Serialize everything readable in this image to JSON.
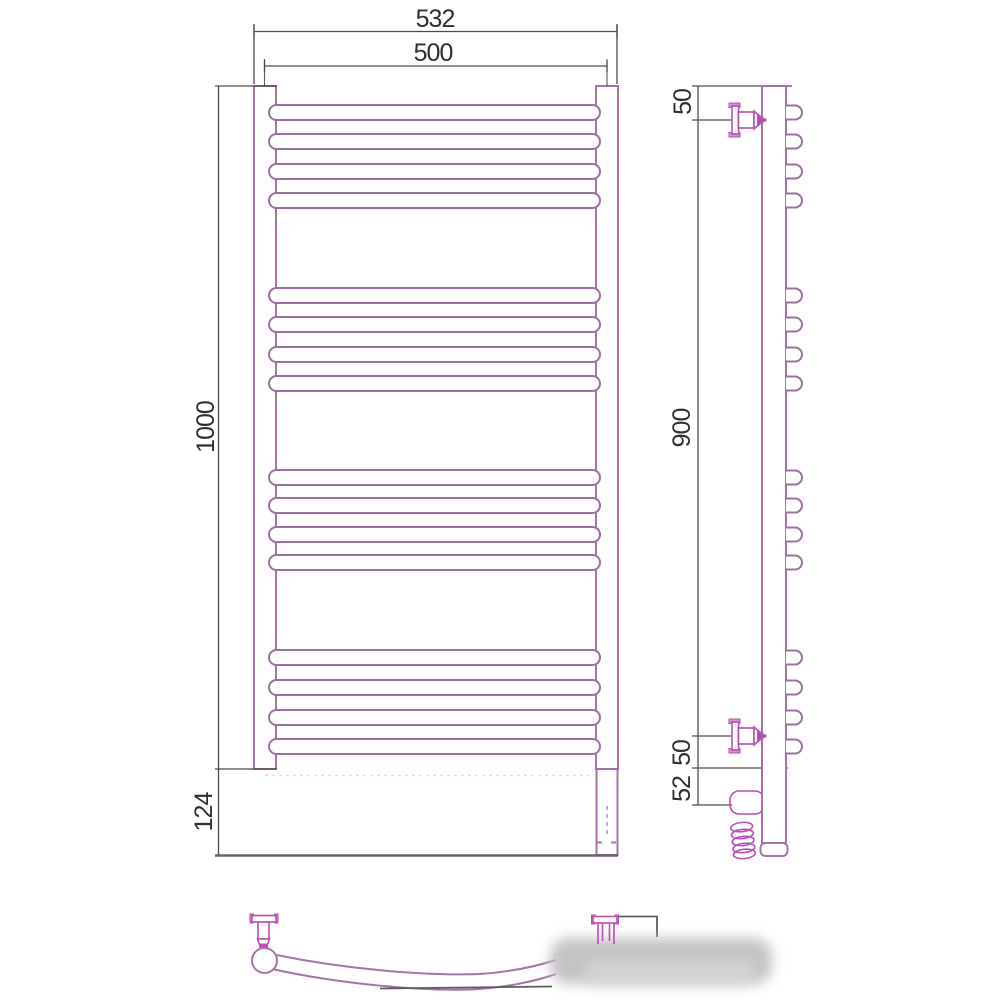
{
  "drawing": {
    "type": "technical-drawing",
    "subject": "curved wall-mounted heated towel rail, orthographic views with dimensions",
    "front": {
      "outer_width": "532",
      "axis_width": "500",
      "total_height": "1000",
      "lower_height": "124",
      "bars_total": 16,
      "bars_per_group": 4,
      "groups": 4
    },
    "side": {
      "top_offset": "50",
      "bracket_span": "900",
      "lower_offset": "50",
      "element_offset": "52"
    },
    "colors": {
      "outline": "#a673a8",
      "accent": "#bb4fb5",
      "dimension": "#4c4c4c",
      "baseline": "#6b5f70",
      "watermark": "#c4c4c4",
      "background": "#ffffff"
    },
    "geometry": {
      "bar_rows": [
        105,
        134,
        164,
        193,
        288,
        317,
        347,
        376,
        470,
        498,
        527,
        555,
        650,
        680,
        710,
        739
      ],
      "bar_height": 15,
      "front_bar_x": 269,
      "front_bar_w": 331,
      "loop_x": 786,
      "loop_w": 16
    }
  }
}
